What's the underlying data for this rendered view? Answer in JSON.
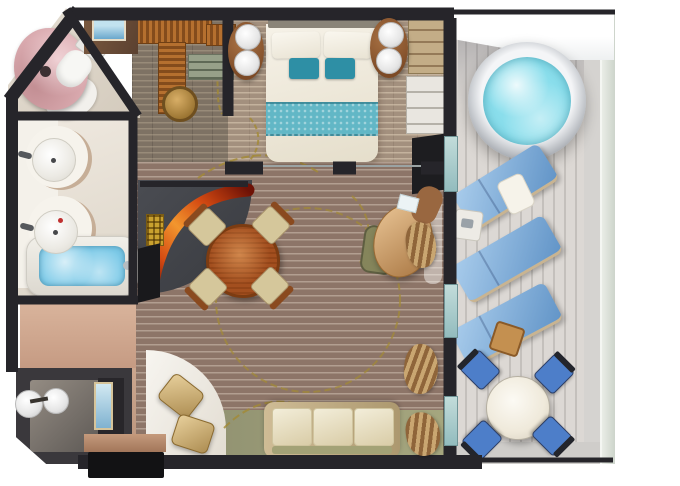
{
  "meta": {
    "description": "Top-down 3D rendered floor plan of a cruise ship suite with bedroom, walk-in closet, marble shower room, double-sink bathroom with tub, living and dining room, entry vestibule and a large private balcony with hot tub",
    "image_type": "floor-plan-render"
  },
  "palette": {
    "wall": "#26252a",
    "background": "#ffffff",
    "carpet_base": "#8d7568",
    "carpet_stripe": "#d6c7b9",
    "vine_gold": "#a38a35",
    "bedroom_floor": "#a3907e",
    "closet_floor": "#7e7264",
    "dining_nook_floor": "#45474c",
    "bathroom_floor": "#ece6dc",
    "entry_floor": "#c8a28c",
    "deck_plank": "#d8d4d0",
    "glass_rail": "#dfe4dd",
    "bed_linen": "#f2eee4",
    "teal_pillow": "#2e8fa5",
    "teal_runner": "#62b7c6",
    "nightstand_wood": "#8a5a33",
    "closet_counter": "#9c5c24",
    "shower_pink": "#d9a9ae",
    "toilet_white": "#f7f7f4",
    "tub_water": "#7ccae8",
    "hot_tub_water": "#8adeec",
    "lounger_blue": "#7cb2e2",
    "balcony_chair_blue": "#4d7ec9",
    "balcony_table_white": "#f4efe8",
    "sofa_frame": "#c4ad7e",
    "sofa_cushion": "#ece4c5",
    "gold_chair": "#cfae6e",
    "dining_table_wood": "#a34f1f",
    "dining_chair_seat": "#d5c79b",
    "desk_wood": "#cf9a5e",
    "red_glass_dark": "#6e1206",
    "red_glass_mid": "#d44a12",
    "red_glass_light": "#f2962e",
    "lamp_gold": "#c9a12f",
    "curtain_tan": "#b08d5f",
    "green_floor": "#9a9b78",
    "picture_blue": "#7ab8d8"
  },
  "rooms": [
    "shower-room",
    "bathroom",
    "walk-in-closet",
    "bedroom",
    "living-dining-room",
    "entry-vestibule",
    "balcony"
  ],
  "furniture": {
    "shower_room": [
      "curved-marble-shower",
      "toilet",
      "wall-picture"
    ],
    "bathroom": [
      "double-sink-vanity",
      "two-round-sinks",
      "bathtub"
    ],
    "walk_in_closet": [
      "l-shaped-counter",
      "drawer-cabinet",
      "round-stool"
    ],
    "bedroom": [
      "king-bed",
      "teal-accent-pillows",
      "teal-bed-runner",
      "two-nightstands",
      "globe-lamps",
      "wardrobe",
      "media-cabinet",
      "tv-panel"
    ],
    "living_dining": [
      "round-dining-table",
      "four-dining-chairs",
      "curved-red-glass-partition",
      "gold-floor-lamp",
      "tv-sideboard",
      "oval-writing-desk",
      "desk-chair",
      "three-seat-sofa",
      "two-gold-armchairs",
      "curtains"
    ],
    "entry": [
      "vestibule-globe-lamps",
      "entry-door",
      "console-table",
      "wall-art"
    ],
    "balcony": [
      "round-hot-tub",
      "three-sun-loungers",
      "lounger-pillow",
      "side-table",
      "wood-stool",
      "round-dining-table",
      "four-blue-chairs",
      "glass-railing",
      "deck-overhang"
    ]
  }
}
